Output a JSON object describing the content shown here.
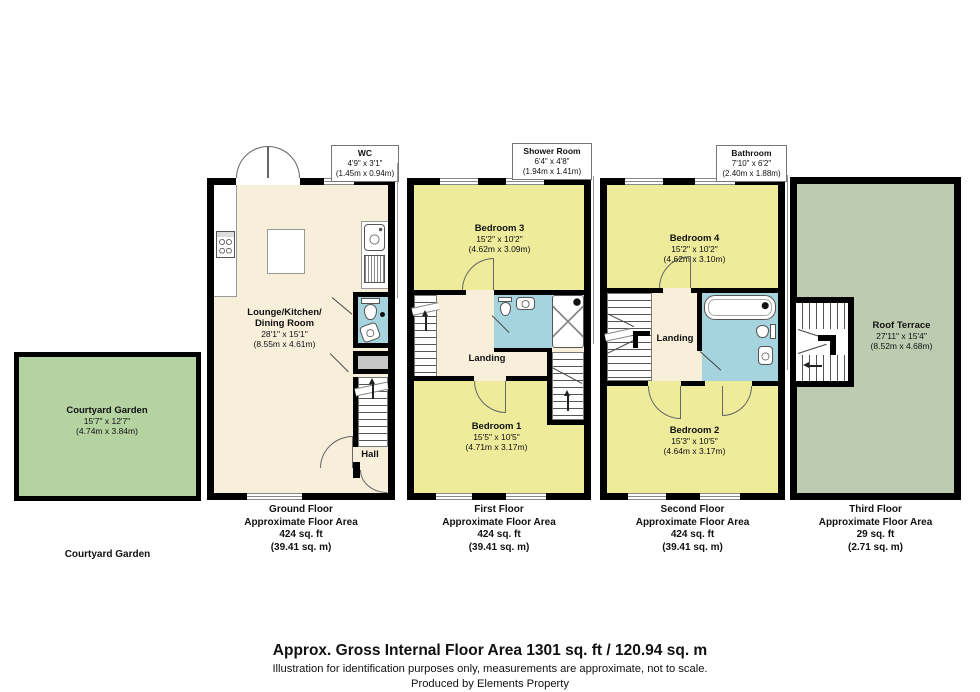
{
  "colors": {
    "wall": "#000000",
    "cream": "#f7efda",
    "yellow": "#eeeb9b",
    "blue": "#a6d4de",
    "garden_green": "#b4d3a1",
    "terrace_green": "#bdccb1",
    "cupboard_gray": "#c6c6c6"
  },
  "callouts": {
    "wc": {
      "name": "WC",
      "dims_ft": "4'9\" x 3'1\"",
      "dims_m": "(1.45m x 0.94m)"
    },
    "shower": {
      "name": "Shower Room",
      "dims_ft": "6'4\" x 4'8\"",
      "dims_m": "(1.94m x 1.41m)"
    },
    "bathroom": {
      "name": "Bathroom",
      "dims_ft": "7'10\" x 6'2\"",
      "dims_m": "(2.40m x 1.88m)"
    }
  },
  "rooms": {
    "courtyard": {
      "name": "Courtyard Garden",
      "dims_ft": "15'7\" x 12'7\"",
      "dims_m": "(4.74m x 3.84m)"
    },
    "lounge": {
      "name": "Lounge/Kitchen/\nDining Room",
      "dims_ft": "28'1\" x 15'1\"",
      "dims_m": "(8.55m x 4.61m)"
    },
    "hall": {
      "name": "Hall"
    },
    "bedroom3": {
      "name": "Bedroom 3",
      "dims_ft": "15'2\" x 10'2\"",
      "dims_m": "(4.62m x 3.09m)"
    },
    "bedroom1": {
      "name": "Bedroom 1",
      "dims_ft": "15'5\" x 10'5\"",
      "dims_m": "(4.71m x 3.17m)"
    },
    "landing1": {
      "name": "Landing"
    },
    "bedroom4": {
      "name": "Bedroom 4",
      "dims_ft": "15'2\" x 10'2\"",
      "dims_m": "(4.62m x 3.10m)"
    },
    "bedroom2": {
      "name": "Bedroom 2",
      "dims_ft": "15'3\" x 10'5\"",
      "dims_m": "(4.64m x 3.17m)"
    },
    "landing2": {
      "name": "Landing"
    },
    "terrace": {
      "name": "Roof Terrace",
      "dims_ft": "27'11\" x 15'4\"",
      "dims_m": "(8.52m x 4.68m)"
    }
  },
  "captions": {
    "courtyard": {
      "line1": "Courtyard Garden"
    },
    "ground": {
      "line1": "Ground Floor",
      "line2": "Approximate Floor Area",
      "line3": "424 sq. ft",
      "line4": "(39.41 sq. m)"
    },
    "first": {
      "line1": "First Floor",
      "line2": "Approximate Floor Area",
      "line3": "424 sq. ft",
      "line4": "(39.41 sq. m)"
    },
    "second": {
      "line1": "Second Floor",
      "line2": "Approximate Floor Area",
      "line3": "424 sq. ft",
      "line4": "(39.41 sq. m)"
    },
    "third": {
      "line1": "Third Floor",
      "line2": "Approximate Floor Area",
      "line3": "29 sq. ft",
      "line4": "(2.71 sq. m)"
    }
  },
  "footer": {
    "title": "Approx. Gross Internal Floor Area 1301 sq. ft / 120.94 sq. m",
    "disclaimer": "Illustration for identification purposes only, measurements are approximate, not to scale.",
    "credit": "Produced by Elements Property"
  }
}
